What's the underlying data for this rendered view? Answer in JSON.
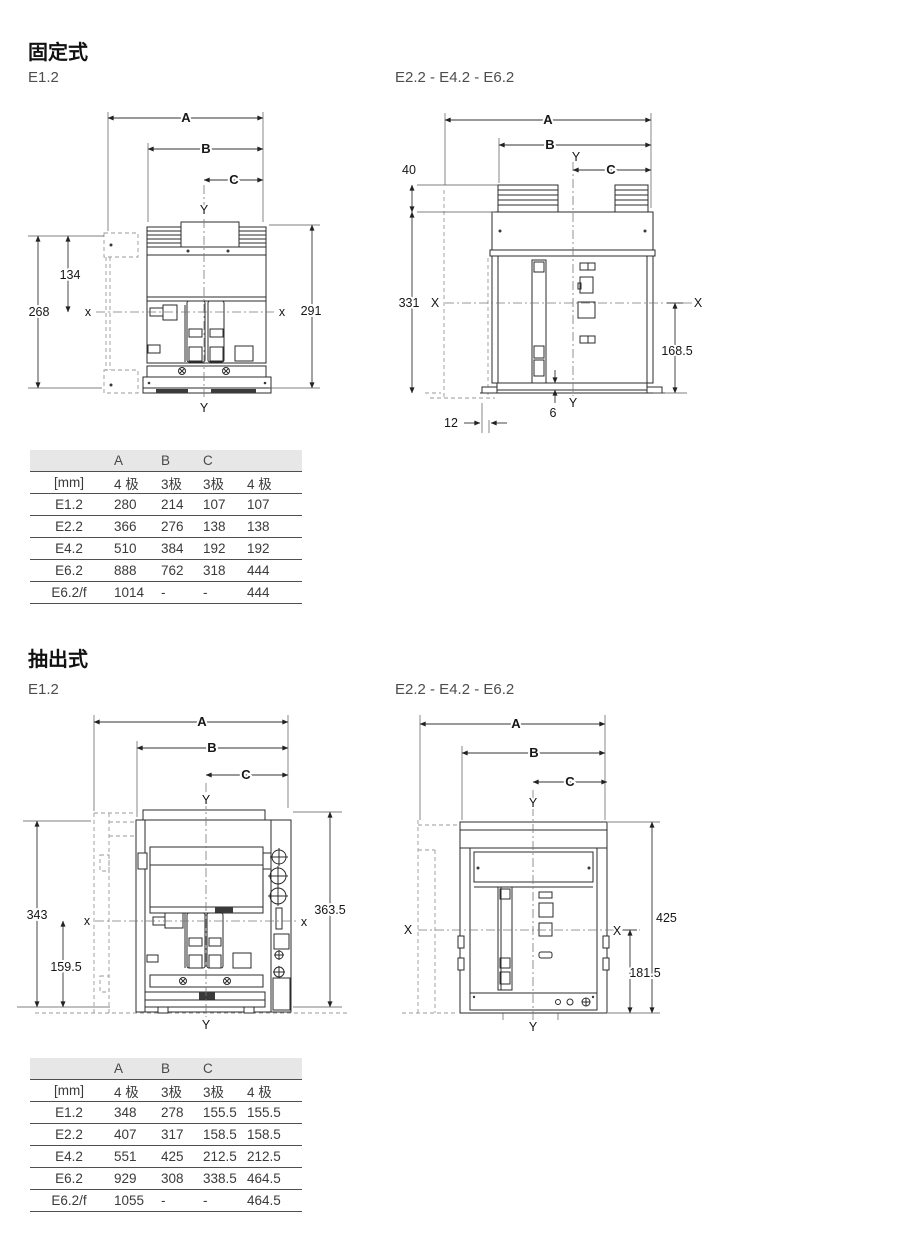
{
  "sections": {
    "fixed": {
      "title": "固定式",
      "left_drawing_label": "E1.2",
      "right_drawing_label": "E2.2 - E4.2 - E6.2"
    },
    "withdrawable": {
      "title": "抽出式",
      "left_drawing_label": "E1.2",
      "right_drawing_label": "E2.2 - E4.2 - E6.2"
    }
  },
  "drawings": {
    "fixed_e12": {
      "dim_a": "A",
      "dim_b": "B",
      "dim_c": "C",
      "axis_y": "Y",
      "axis_x": "x",
      "height_upper": "134",
      "height_total": "268",
      "height_overall": "291"
    },
    "fixed_e22": {
      "dim_a": "A",
      "dim_b": "B",
      "dim_c": "C",
      "axis_y": "Y",
      "axis_x": "X",
      "terminal_height": "40",
      "height_total": "331",
      "height_lower": "168.5",
      "base_offset": "6",
      "foot_offset": "12"
    },
    "wd_e12": {
      "dim_a": "A",
      "dim_b": "B",
      "dim_c": "C",
      "axis_y": "Y",
      "axis_x": "x",
      "height_total": "343",
      "height_lower": "159.5",
      "height_overall": "363.5"
    },
    "wd_e22": {
      "dim_a": "A",
      "dim_b": "B",
      "dim_c": "C",
      "axis_y": "Y",
      "axis_x": "X",
      "height_overall": "425",
      "height_lower": "181.5"
    }
  },
  "tables": {
    "fixed": {
      "letters": {
        "a": "A",
        "b": "B",
        "c": "C"
      },
      "unit_row": [
        "[mm]",
        "4 极",
        "3极",
        "3极",
        "4 极"
      ],
      "rows": [
        [
          "E1.2",
          "280",
          "214",
          "107",
          "107"
        ],
        [
          "E2.2",
          "366",
          "276",
          "138",
          "138"
        ],
        [
          "E4.2",
          "510",
          "384",
          "192",
          "192"
        ],
        [
          "E6.2",
          "888",
          "762",
          "318",
          "444"
        ],
        [
          "E6.2/f",
          "1014",
          "-",
          "-",
          "444"
        ]
      ]
    },
    "withdrawable": {
      "letters": {
        "a": "A",
        "b": "B",
        "c": "C"
      },
      "unit_row": [
        "[mm]",
        "4 极",
        "3极",
        "3极",
        "4 极"
      ],
      "rows": [
        [
          "E1.2",
          "348",
          "278",
          "155.5",
          "155.5"
        ],
        [
          "E2.2",
          "407",
          "317",
          "158.5",
          "158.5"
        ],
        [
          "E4.2",
          "551",
          "425",
          "212.5",
          "212.5"
        ],
        [
          "E6.2",
          "929",
          "308",
          "338.5",
          "464.5"
        ],
        [
          "E6.2/f",
          "1055",
          "-",
          "-",
          "464.5"
        ]
      ]
    }
  }
}
